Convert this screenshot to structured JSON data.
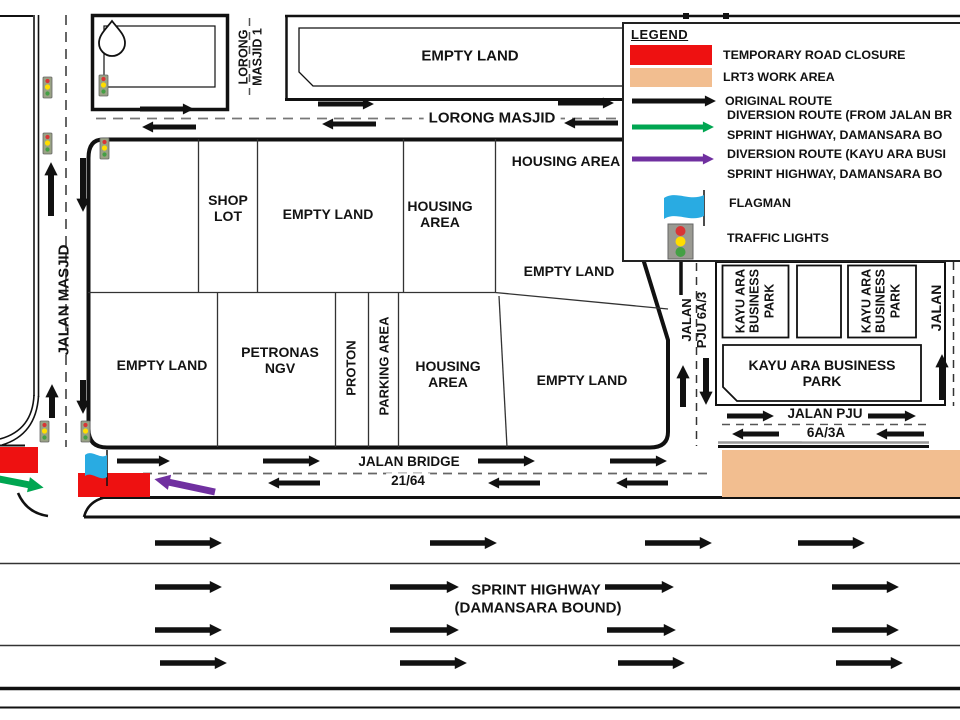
{
  "legend": {
    "title": "LEGEND",
    "closure_label": "TEMPORARY ROAD CLOSURE",
    "lrt3_label": "LRT3 WORK AREA",
    "original_route_label": "ORIGINAL ROUTE",
    "diversion_green_line1": "DIVERSION ROUTE (FROM JALAN BR",
    "diversion_green_line2": "SPRINT HIGHWAY, DAMANSARA BO",
    "diversion_purple_line1": "DIVERSION ROUTE (KAYU ARA BUSI",
    "diversion_purple_line2": "SPRINT HIGHWAY, DAMANSARA BO",
    "flagman_label": "FLAGMAN",
    "traffic_lights_label": "TRAFFIC LIGHTS"
  },
  "colors": {
    "closure_red": "#EE1111",
    "lrt3_tan": "#F2BE90",
    "original_black": "#111111",
    "diversion_green": "#00A651",
    "diversion_purple": "#7030A0",
    "flag_blue": "#29ABE2",
    "traffic_light_red": "#D93535",
    "traffic_light_yellow": "#FFDD00",
    "traffic_light_green": "#44A044"
  },
  "labels": {
    "empty_land_top": "EMPTY LAND",
    "lorong_masjid_1_l1": "LORONG",
    "lorong_masjid_1_l2": "MASJID 1",
    "lorong_masjid": "LORONG MASJID",
    "housing_area_ne": "HOUSING AREA",
    "shop_lot_l1": "SHOP",
    "shop_lot_l2": "LOT",
    "empty_land_mid": "EMPTY LAND",
    "housing_area_mid_l1": "HOUSING",
    "housing_area_mid_l2": "AREA",
    "empty_land_e": "EMPTY LAND",
    "jalan_masjid": "JALAN MASJID",
    "empty_land_sw": "EMPTY LAND",
    "petronas_l1": "PETRONAS",
    "petronas_l2": "NGV",
    "proton": "PROTON",
    "parking_area": "PARKING AREA",
    "housing_area_s_l1": "HOUSING",
    "housing_area_s_l2": "AREA",
    "empty_land_se": "EMPTY LAND",
    "jalan_pju_6a3_l1": "JALAN",
    "jalan_pju_6a3_l2": "PJU 6A/3",
    "kayu_vert_l1": "KAYU ARA",
    "kayu_vert_l2": "BUSINESS",
    "kayu_vert_l3": "PARK",
    "kayu_big_l1": "KAYU ARA BUSINESS",
    "kayu_big_l2": "PARK",
    "jalan_right": "JALAN",
    "jalan_pju_6a3a_l1": "JALAN PJU",
    "jalan_pju_6a3a_l2": "6A/3A",
    "jalan_bridge_l1": "JALAN BRIDGE",
    "jalan_bridge_l2": "21/64",
    "sprint_l1": "SPRINT HIGHWAY",
    "sprint_l2": "(DAMANSARA BOUND)"
  }
}
